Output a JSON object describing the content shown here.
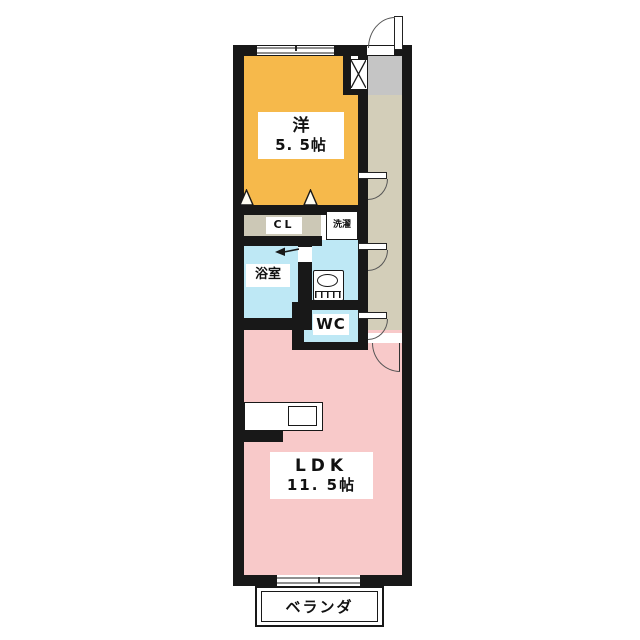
{
  "plan_title": "1LDK apartment floor plan",
  "rooms": {
    "western_room": {
      "name": "洋",
      "size": "5. 5帖"
    },
    "ldk": {
      "name": "LDK",
      "size": "11. 5帖"
    },
    "bathroom": {
      "label": "浴室"
    },
    "toilet": {
      "label": "WC"
    },
    "closet": {
      "label": "CL"
    },
    "laundry": {
      "label": "洗濯"
    },
    "balcony": {
      "label": "ベランダ"
    }
  },
  "colors": {
    "wall": "#181818",
    "western_room_fill": "#F6B94B",
    "ldk_fill": "#F8C9C9",
    "wet_area_fill": "#BEE8F5",
    "corridor_fill": "#D3CEB9",
    "entrance_fill": "#C5C5C5",
    "closet_fill": "#CCC8B6"
  }
}
